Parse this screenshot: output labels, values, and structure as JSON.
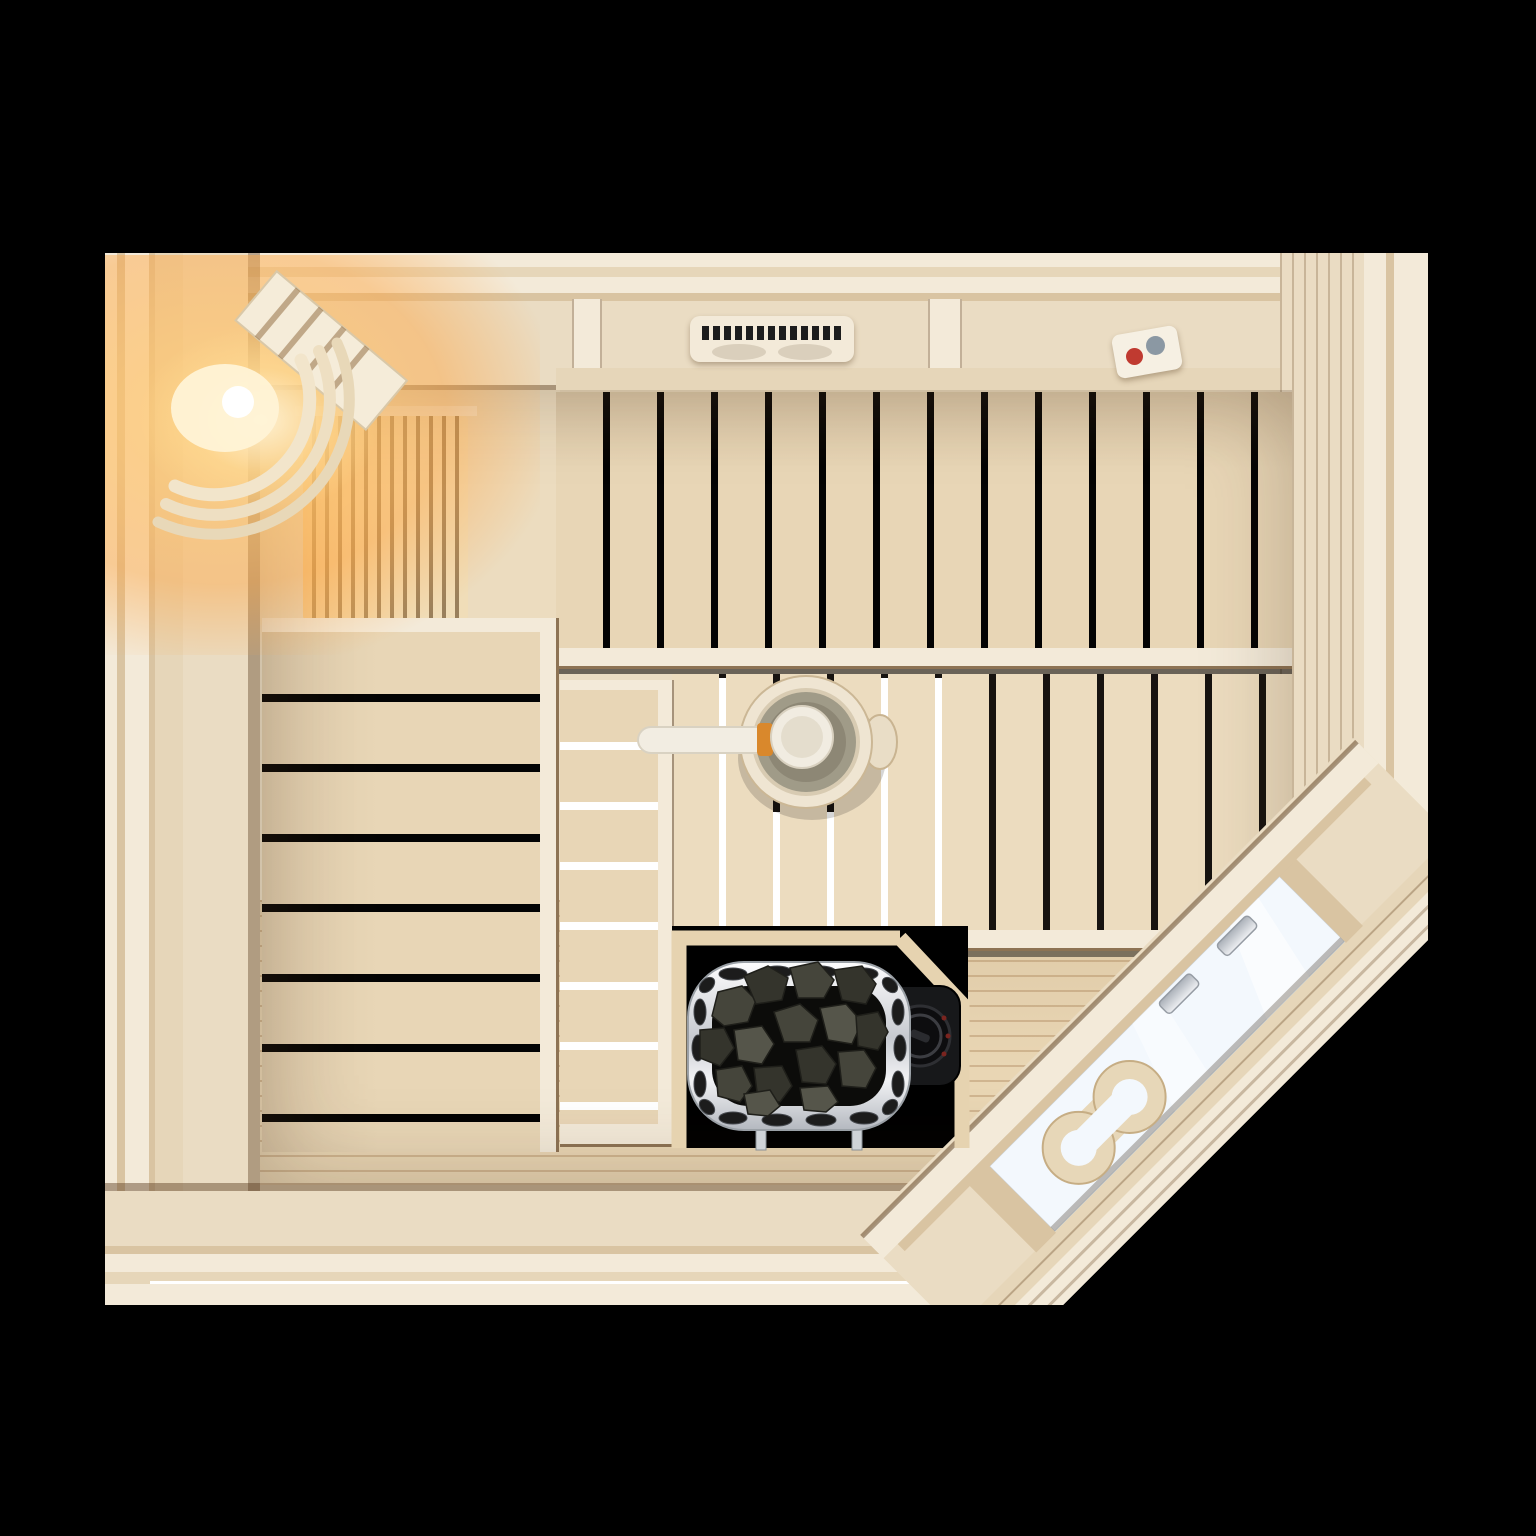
{
  "scene": {
    "description": "top-down view of a wooden sauna room with corner glass door",
    "background": "#000000"
  },
  "palette": {
    "bg": "#000000",
    "wood-face": "#eadcc3",
    "wood-light": "#f3ead9",
    "wood-mid": "#e6d6b9",
    "wood-dark": "#d9c4a2",
    "wood-edge": "#8d7354",
    "bench": "#e8d6b6",
    "bench2": "#ecdcbf",
    "floor": "#e9d6b4",
    "gap-black": "#030303",
    "gap-white": "#ffffff",
    "glow-warm": "#ffb869",
    "glow-bright": "#fff3d6",
    "glass": "#f3f8fd",
    "chrome-light": "#f4f5f7",
    "chrome-dark": "#b9bec6",
    "steel-stroke": "#969ca4",
    "stone-dark": "#34342c",
    "stone-mid": "#45453b",
    "stone-light": "#55554a",
    "unit-black": "#17181a",
    "water": "#8d8775",
    "ladle-wood": "#f2ede2",
    "orange-band": "#d9882c",
    "sensor-red": "#c03a30",
    "sensor-grey": "#8b98a3"
  },
  "objects": {
    "walls": {
      "label": "sauna wall frame"
    },
    "floor": {
      "label": "wooden floor boards"
    },
    "upper_bench": {
      "label": "upper bench with vertical slats"
    },
    "lower_bench": {
      "label": "lower bench with vertical slats"
    },
    "side_bench": {
      "label": "left side bench with horizontal slats"
    },
    "step_bench": {
      "label": "middle step bench"
    },
    "backrest": {
      "label": "slatted backrest panel"
    },
    "corner_light": {
      "label": "corner sauna light with wooden shade"
    },
    "vent": {
      "label": "ceiling ventilation grille"
    },
    "sensor": {
      "label": "temperature sensor unit"
    },
    "bucket": {
      "label": "wooden sauna bucket with water"
    },
    "ladle": {
      "label": "sauna ladle"
    },
    "heater": {
      "label": "electric sauna heater with stones"
    },
    "heater_control": {
      "label": "heater control unit with dial"
    },
    "glass_door": {
      "label": "corner glass door"
    },
    "door_handle": {
      "label": "wooden door handle"
    },
    "door_hinges": {
      "label": "chrome door hinges"
    }
  }
}
